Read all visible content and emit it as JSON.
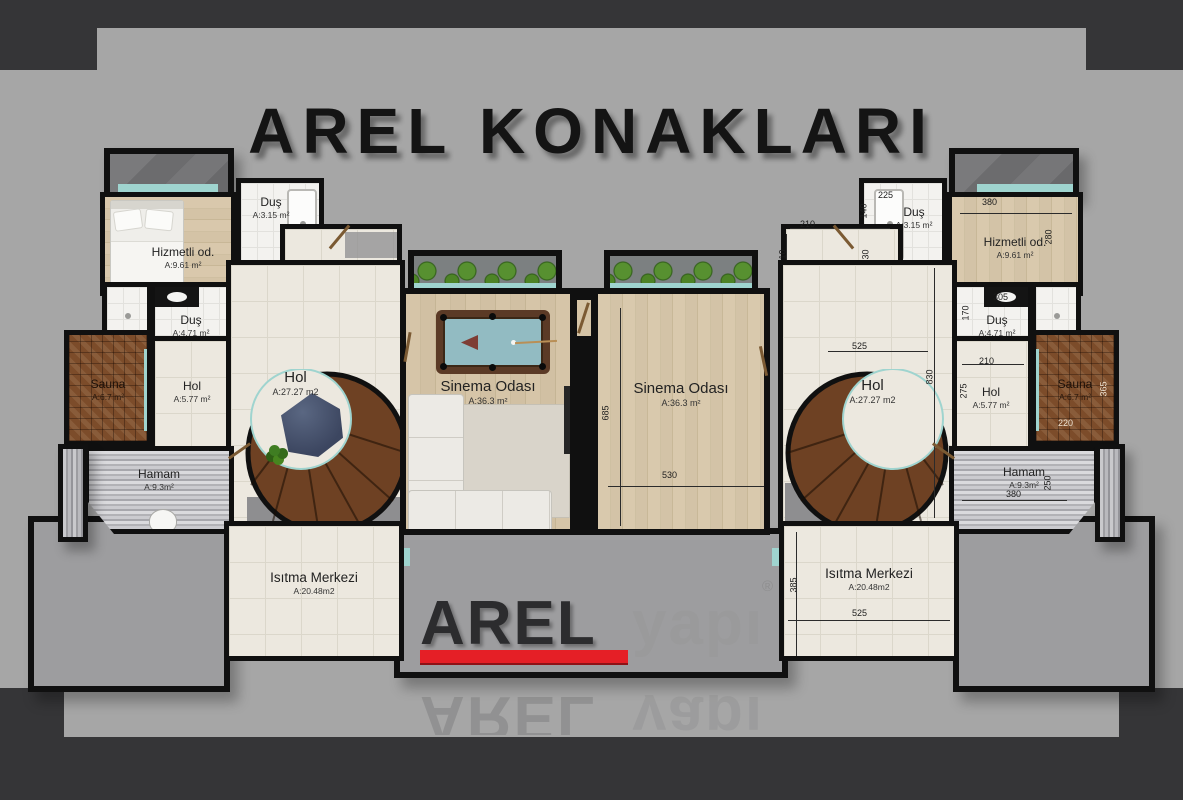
{
  "title": "AREL KONAKLARI",
  "logo": {
    "arel": "AREL",
    "yapi": "yapı",
    "registered": "®"
  },
  "colors": {
    "accent_red": "#e51f26",
    "wall": "#101010",
    "background": "#a6a6a6",
    "band": "#353537",
    "teal_glass": "#9fd4cf"
  },
  "rooms": {
    "left": {
      "hizmetli": {
        "name": "Hizmetli od.",
        "area": "A:9.61 m²"
      },
      "dus_top": {
        "name": "Duş",
        "area": "A:3.15 m²"
      },
      "camasir": {
        "name": "Çamaşır .od",
        "area": "A:8.72 m²"
      },
      "dus_mid": {
        "name": "Duş",
        "area": "A:4.71 m²"
      },
      "sauna": {
        "name": "Sauna",
        "area": "A:6.7 m²"
      },
      "hol_small": {
        "name": "Hol",
        "area": "A:5.77 m²"
      },
      "elevator": {
        "name": "AS"
      },
      "hol_big": {
        "name": "Hol",
        "area": "A:27.27 m2"
      },
      "hamam": {
        "name": "Hamam",
        "area": "A:9.3m²"
      },
      "isitma": {
        "name": "Isıtma Merkezi",
        "area": "A:20.48m2"
      },
      "cinema": {
        "name": "Sinema Odası",
        "area": "A:36.3 m²"
      }
    },
    "right": {
      "hizmetli": {
        "name": "Hizmetli od.",
        "area": "A:9.61 m²"
      },
      "dus_top": {
        "name": "Duş",
        "area": "A:3.15 m²"
      },
      "camasir": {
        "name": "Çamaşır .od",
        "area": "A:8.72 m²"
      },
      "dus_mid": {
        "name": "Duş",
        "area": "A:4.71 m²"
      },
      "sauna": {
        "name": "Sauna",
        "area": "A:6.7 m²"
      },
      "hol_small": {
        "name": "Hol",
        "area": "A:5.77 m²"
      },
      "elevator": {
        "name": "AS"
      },
      "hol_big": {
        "name": "Hol",
        "area": "A:27.27 m2"
      },
      "hamam": {
        "name": "Hamam",
        "area": "A:9.3m²"
      },
      "isitma": {
        "name": "Isıtma Merkezi",
        "area": "A:20.48m2"
      },
      "cinema": {
        "name": "Sinema Odası",
        "area": "A:36.3 m²"
      }
    }
  },
  "dims": {
    "dus_top_width": "225",
    "dus_top_left": "140",
    "camasir_top": "210",
    "camasir_left": "310",
    "camasir_bottom": "390",
    "camasir_right": "130",
    "hizmetli_top": "380",
    "hizmetli_right": "280",
    "dus_mid_top": "305",
    "dus_mid_left": "170",
    "hol_small_top": "210",
    "hol_small_left": "275",
    "sauna_bottom": "220",
    "sauna_right": "365",
    "as_bottom": "525",
    "hol_right": "830",
    "hamam_width": "380",
    "hamam_right": "250",
    "isitma_left": "385",
    "isitma_bottom": "525",
    "cinema_height": "685",
    "cinema_width": "530"
  }
}
